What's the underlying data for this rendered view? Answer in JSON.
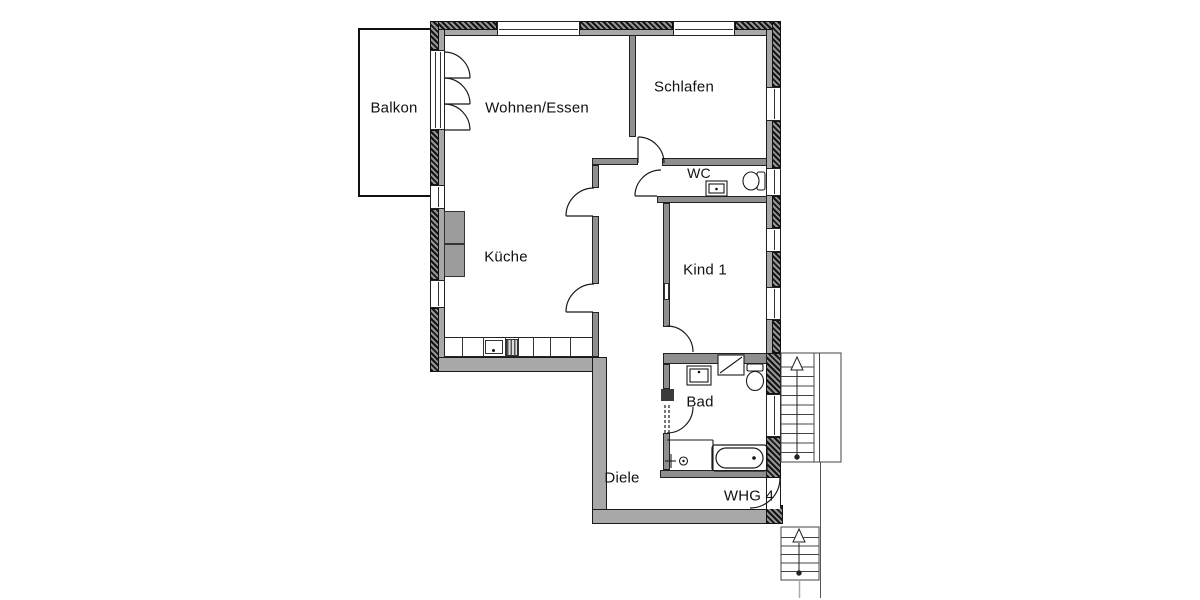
{
  "plan": {
    "title": "Apartment floor plan",
    "apartment_label": "WHG 4",
    "rooms": [
      {
        "id": "balkon",
        "label": "Balkon"
      },
      {
        "id": "wohnen-essen",
        "label": "Wohnen/Essen"
      },
      {
        "id": "schlafen",
        "label": "Schlafen"
      },
      {
        "id": "wc",
        "label": "WC"
      },
      {
        "id": "kueche",
        "label": "Küche"
      },
      {
        "id": "kind-1",
        "label": "Kind 1"
      },
      {
        "id": "bad",
        "label": "Bad"
      },
      {
        "id": "diele",
        "label": "Diele"
      }
    ],
    "stairs": {
      "upper_direction": "up",
      "lower_direction": "up"
    },
    "fixtures": [
      "bathtub",
      "toilet-bad",
      "toilet-wc",
      "sink-bad",
      "sink-wc",
      "shower",
      "washer-niche",
      "kitchen-counter",
      "kitchen-sink",
      "stove"
    ],
    "colors": {
      "exterior_wall": "#a8a8a8",
      "interior_wall": "#8f8f8f",
      "hatch_dark": "#141414",
      "line": "#1a1a1a",
      "text": "#111111",
      "background": "#ffffff"
    }
  }
}
